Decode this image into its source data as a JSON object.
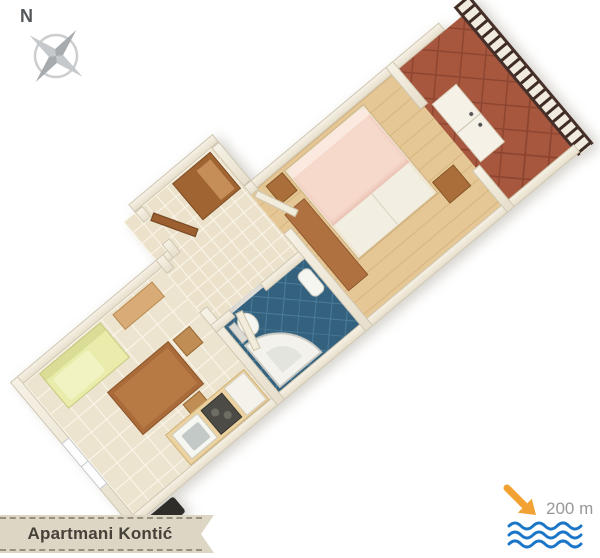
{
  "compass": {
    "label": "N",
    "icon": "compass-rose-icon",
    "color": "#aaadaf"
  },
  "banner": {
    "label": "Apartmani Kontić",
    "background": "#ddd6c4",
    "text_color": "#474239"
  },
  "beach_indicator": {
    "distance_label": "200 m",
    "arrow_icon": "arrow-to-sea-icon",
    "waves_icon": "sea-waves-icon",
    "arrow_color": "#f1a233",
    "wave_color": "#1b76c7",
    "text_color": "#97989a"
  },
  "floor_plan": {
    "wall_color": "#ece5d4",
    "rooms": [
      {
        "name": "living-room-kitchen",
        "floor_color": "#ede4cf"
      },
      {
        "name": "entry-hall",
        "floor_color": "#ece2cc"
      },
      {
        "name": "bathroom",
        "floor_color": "#33617e"
      },
      {
        "name": "bedroom",
        "floor_color": "#e5c795"
      },
      {
        "name": "terrace",
        "floor_color": "#a6573d"
      }
    ],
    "furniture_colors": {
      "wood_brown": "#a96e39",
      "sofa_yellow": "#e9ecab",
      "bed_pink": "#f7d9cc",
      "railing_dark": "#3e2c24"
    }
  }
}
